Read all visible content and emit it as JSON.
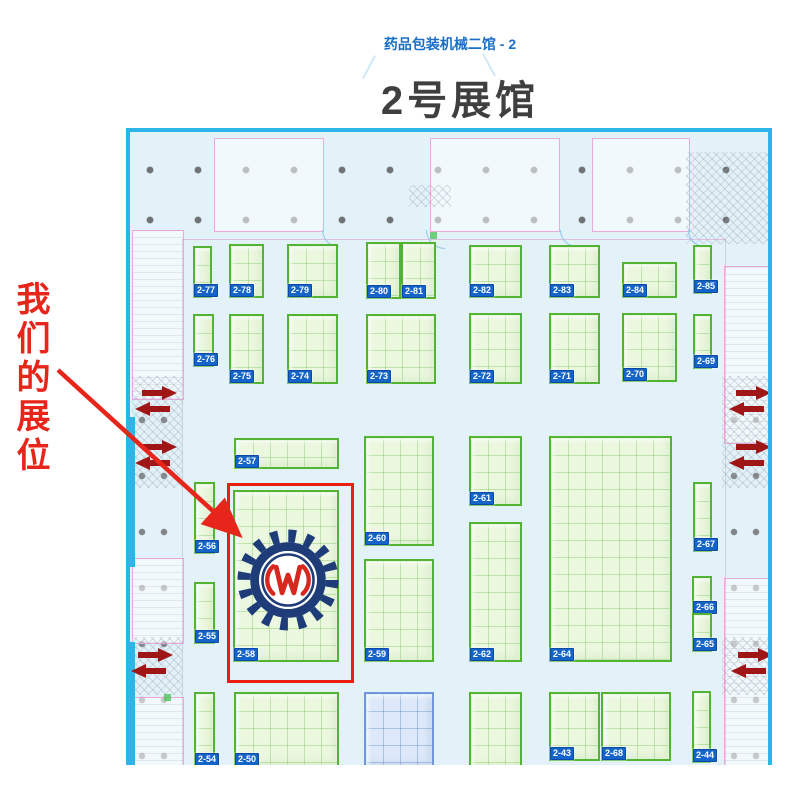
{
  "header": {
    "hall_link": "药品包装机械二馆 - 2",
    "hall_title": "2号展馆"
  },
  "annotation": {
    "our_booth_label": "我们的展位",
    "highlighted_booth": "2-58",
    "accent_color": "#e8251a"
  },
  "logo": {
    "name": "gear-W-logo",
    "gear_color": "#1e3c78",
    "glyph_color": "#d6281e",
    "glyph": "W"
  },
  "map": {
    "border_color": "#2db5e8",
    "booth_border_color": "#53b434",
    "badge_color": "#1565c8",
    "exit_arrow_color": "#a01616",
    "booths": [
      {
        "id": "2-77",
        "x": 63,
        "y": 114,
        "w": 19,
        "h": 52
      },
      {
        "id": "2-78",
        "x": 99,
        "y": 112,
        "w": 35,
        "h": 54
      },
      {
        "id": "2-79",
        "x": 157,
        "y": 112,
        "w": 51,
        "h": 54
      },
      {
        "id": "2-80",
        "x": 236,
        "y": 110,
        "w": 35,
        "h": 57
      },
      {
        "id": "2-81",
        "x": 271,
        "y": 110,
        "w": 35,
        "h": 57
      },
      {
        "id": "2-82",
        "x": 339,
        "y": 113,
        "w": 53,
        "h": 53
      },
      {
        "id": "2-83",
        "x": 419,
        "y": 113,
        "w": 51,
        "h": 53
      },
      {
        "id": "2-84",
        "x": 492,
        "y": 130,
        "w": 55,
        "h": 36
      },
      {
        "id": "2-85",
        "x": 563,
        "y": 113,
        "w": 19,
        "h": 49
      },
      {
        "id": "2-76",
        "x": 63,
        "y": 182,
        "w": 21,
        "h": 53
      },
      {
        "id": "2-75",
        "x": 99,
        "y": 182,
        "w": 35,
        "h": 70
      },
      {
        "id": "2-74",
        "x": 157,
        "y": 182,
        "w": 51,
        "h": 70
      },
      {
        "id": "2-73",
        "x": 236,
        "y": 182,
        "w": 70,
        "h": 70
      },
      {
        "id": "2-72",
        "x": 339,
        "y": 181,
        "w": 53,
        "h": 71
      },
      {
        "id": "2-71",
        "x": 419,
        "y": 181,
        "w": 51,
        "h": 71
      },
      {
        "id": "2-70",
        "x": 492,
        "y": 181,
        "w": 55,
        "h": 69
      },
      {
        "id": "2-69",
        "x": 563,
        "y": 182,
        "w": 19,
        "h": 55
      },
      {
        "id": "2-57",
        "x": 104,
        "y": 306,
        "w": 105,
        "h": 31
      },
      {
        "id": "2-56",
        "x": 64,
        "y": 350,
        "w": 21,
        "h": 72
      },
      {
        "id": "2-58",
        "x": 103,
        "y": 358,
        "w": 106,
        "h": 172
      },
      {
        "id": "2-60",
        "x": 234,
        "y": 304,
        "w": 70,
        "h": 110
      },
      {
        "id": "2-61",
        "x": 339,
        "y": 304,
        "w": 53,
        "h": 70
      },
      {
        "id": "2-64",
        "x": 419,
        "y": 304,
        "w": 123,
        "h": 226
      },
      {
        "id": "2-62",
        "x": 339,
        "y": 390,
        "w": 53,
        "h": 140
      },
      {
        "id": "2-59",
        "x": 234,
        "y": 427,
        "w": 70,
        "h": 103
      },
      {
        "id": "2-55",
        "x": 64,
        "y": 450,
        "w": 21,
        "h": 62
      },
      {
        "id": "2-67",
        "x": 563,
        "y": 350,
        "w": 19,
        "h": 70
      },
      {
        "id": "2-66",
        "x": 562,
        "y": 444,
        "w": 20,
        "h": 39
      },
      {
        "id": "2-65",
        "x": 562,
        "y": 481,
        "w": 20,
        "h": 39
      },
      {
        "id": "2-54",
        "x": 64,
        "y": 560,
        "w": 21,
        "h": 75
      },
      {
        "id": "2-50",
        "x": 104,
        "y": 560,
        "w": 105,
        "h": 75
      },
      {
        "id": "",
        "x": 234,
        "y": 560,
        "w": 70,
        "h": 76,
        "style": "blue"
      },
      {
        "id": "",
        "x": 339,
        "y": 560,
        "w": 53,
        "h": 77
      },
      {
        "id": "2-43",
        "x": 419,
        "y": 560,
        "w": 51,
        "h": 69
      },
      {
        "id": "2-68",
        "x": 471,
        "y": 560,
        "w": 70,
        "h": 69
      },
      {
        "id": "2-44",
        "x": 562,
        "y": 559,
        "w": 19,
        "h": 72
      }
    ],
    "exit_arrows": {
      "positions": [
        {
          "x": 4,
          "y": 252
        },
        {
          "x": 4,
          "y": 306
        },
        {
          "x": 0,
          "y": 514
        },
        {
          "x": 598,
          "y": 252
        },
        {
          "x": 598,
          "y": 306
        },
        {
          "x": 600,
          "y": 514
        }
      ]
    }
  }
}
